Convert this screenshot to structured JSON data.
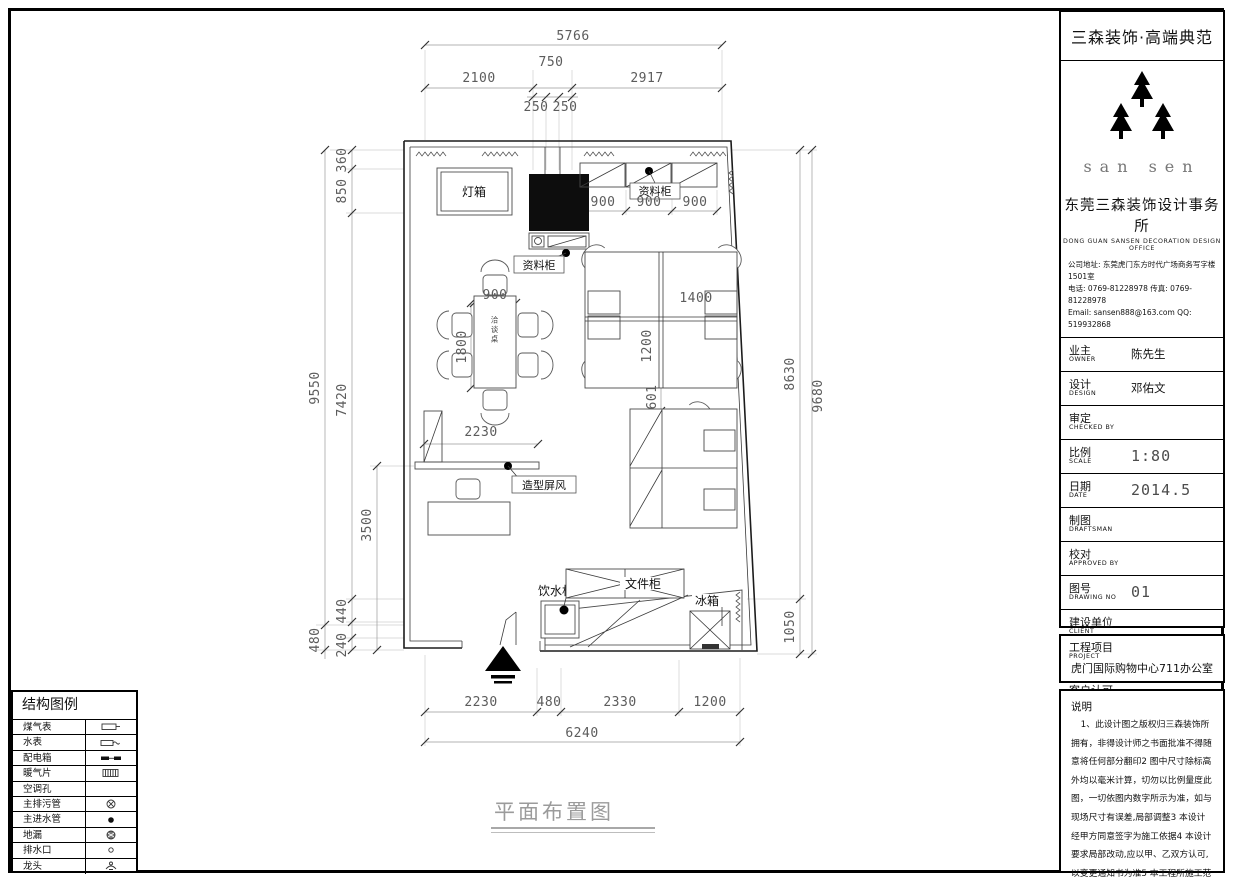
{
  "title_block": {
    "brand": "三森装饰·高端典范",
    "logo_text": "san sen",
    "company_cn": "东莞三森装饰设计事务所",
    "company_en": "DONG GUAN SANSEN DECORATION DESIGN OFFICE",
    "address": "公司地址: 东莞虎门东方时代广场商务写字楼1501室",
    "phone": "电话: 0769-81228978  传真: 0769-81228978",
    "email": "Email: sansen888@163.com  QQ: 519932868",
    "fields": [
      {
        "cn": "业主",
        "en": "OWNER",
        "value": "陈先生"
      },
      {
        "cn": "设计",
        "en": "DESIGN",
        "value": "邓佑文"
      },
      {
        "cn": "审定",
        "en": "CHECKED BY",
        "value": ""
      },
      {
        "cn": "比例",
        "en": "SCALE",
        "value": "1:80"
      },
      {
        "cn": "日期",
        "en": "DATE",
        "value": "2014.5"
      },
      {
        "cn": "制图",
        "en": "DRAFTSMAN",
        "value": ""
      },
      {
        "cn": "校对",
        "en": "APPROVED BY",
        "value": ""
      },
      {
        "cn": "图号",
        "en": "DRAWING NO",
        "value": "01"
      },
      {
        "cn": "建设单位",
        "en": "CLIENT",
        "value": ""
      },
      {
        "cn": "图名",
        "en": "DRAWING TITLE",
        "value": ""
      },
      {
        "cn": "客户认可",
        "en": "APPROVED",
        "value": ""
      }
    ],
    "project": {
      "cn": "工程项目",
      "en": "PROJECT",
      "value": "虎门国际购物中心711办公室"
    },
    "notes_title": "说明",
    "notes_body": "1、此设计图之版权归三森装饰所拥有，非得设计师之书面批准不得随意将任何部分翻印2 图中尺寸除标高外均以毫米计算，切勿以比例量度此图，一切依图内数字所示为准，如与现场尺寸有误差,局部调整3 本设计经甲方同意签字为施工依据4 本设计要求局部改动,应以甲、乙双方认可,以变更通知书为准5 本工程所施工范围，以报价单所含范围为准增减项目以变更通知书为依据。"
  },
  "legend": {
    "title": "结构图例",
    "items": [
      {
        "label": "煤气表",
        "symbol": "gas-meter-icon"
      },
      {
        "label": "水表",
        "symbol": "water-meter-icon"
      },
      {
        "label": "配电箱",
        "symbol": "distribution-box-icon"
      },
      {
        "label": "暖气片",
        "symbol": "radiator-icon"
      },
      {
        "label": "空调孔",
        "symbol": "ac-hole-icon"
      },
      {
        "label": "主排污管",
        "symbol": "sewage-pipe-icon"
      },
      {
        "label": "主进水管",
        "symbol": "water-inlet-icon"
      },
      {
        "label": "地漏",
        "symbol": "floor-drain-icon"
      },
      {
        "label": "排水口",
        "symbol": "drain-outlet-icon"
      },
      {
        "label": "龙头",
        "symbol": "faucet-icon"
      }
    ]
  },
  "plan": {
    "caption": "平面布置图",
    "labels": {
      "light_box": "灯箱",
      "cabinet_top": "资料柜",
      "cabinet_col": "资料柜",
      "screen": "造型屏风",
      "water_dispenser": "饮水机",
      "file_cabinet": "文件柜",
      "fridge": "冰箱",
      "table_tag": "洽谈桌"
    },
    "dims": {
      "top_total": "5766",
      "top_chain": [
        "2100",
        "750",
        "2917"
      ],
      "top_sub": [
        "250",
        "250"
      ],
      "cab_row": [
        "900",
        "900",
        "900"
      ],
      "left_outer": "9550",
      "left_outer_bottom": "480",
      "left_chain": [
        "360",
        "850",
        "7420",
        "440",
        "240"
      ],
      "left_inner": "3500",
      "right_inner": "8630",
      "right_inner_bottom": "1050",
      "right_outer": "9680",
      "bottom_chain": [
        "2230",
        "480",
        "2330",
        "1200"
      ],
      "bottom_total": "6240",
      "table_w": "900",
      "table_l": "1800",
      "ws_w": "1400",
      "ws_h": "1200",
      "ws_gap": "601",
      "screen_w": "2230"
    }
  }
}
